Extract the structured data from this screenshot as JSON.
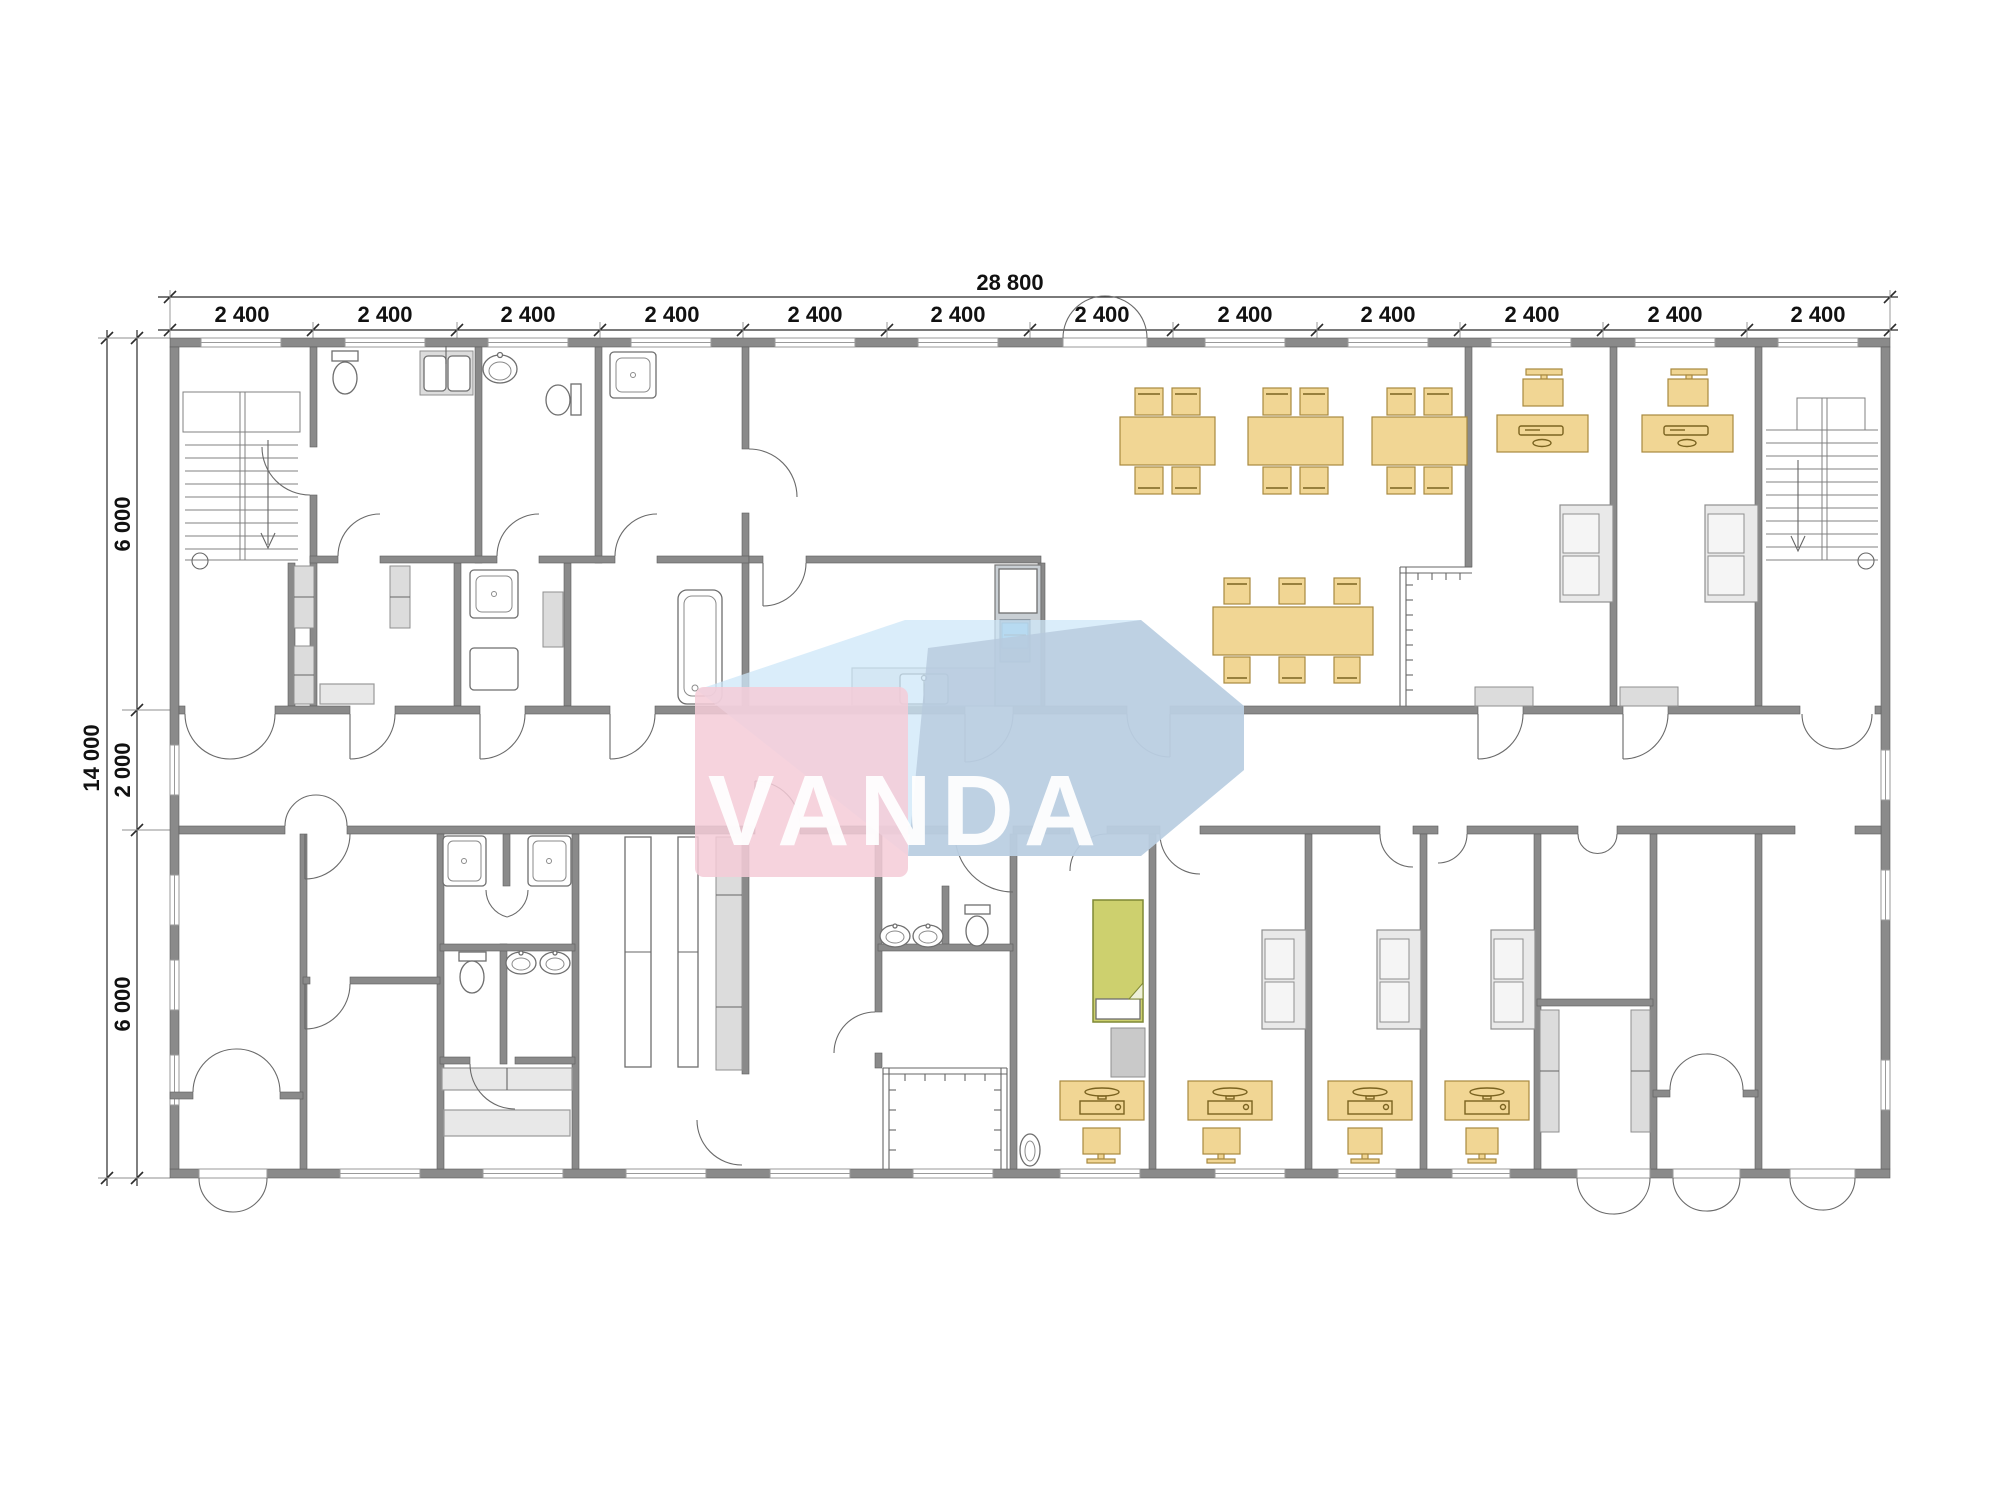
{
  "colors": {
    "wall": "#8a8a8a",
    "furniture": "#f1d694",
    "furniture_stroke": "#a8893f",
    "sofa": "#e9e9e9",
    "bed": "#cdd06e",
    "wm_pink": "#f5cbd7",
    "wm_blue_light": "#cde7f8",
    "wm_blue_steel": "#b7c9dd",
    "wm_text": "#ffffff"
  },
  "watermark": {
    "text": "VANDA"
  },
  "dimensions": {
    "horizontal": {
      "total": "28 800",
      "bays": [
        "2 400",
        "2 400",
        "2 400",
        "2 400",
        "2 400",
        "2 400",
        "2 400",
        "2 400",
        "2 400",
        "2 400",
        "2 400",
        "2 400"
      ]
    },
    "vertical": {
      "total": "14 000",
      "segments": [
        "6 000",
        "2 000",
        "6 000"
      ]
    }
  }
}
